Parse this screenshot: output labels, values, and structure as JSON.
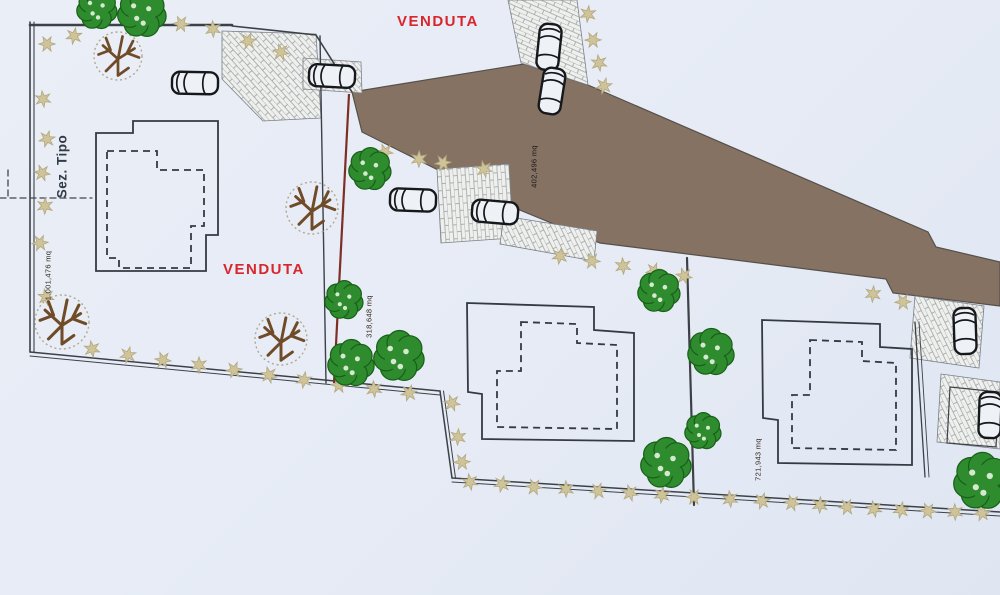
{
  "labels": {
    "venduta_top": "VENDUTA",
    "venduta_left": "VENDUTA",
    "section_label": "Sez. Tipo"
  },
  "measurements": {
    "area_left": "1.001,476 mq",
    "area_road": "402,496 mq",
    "area_middle": "318,648 mq",
    "area_right": "721,943 mq"
  },
  "colors": {
    "background": "#e8edf6",
    "road": "#867263",
    "boundary_red": "#7e2f24",
    "venduta_text": "#d8262c",
    "line_dark": "#3c4148",
    "tree_green": "#2e8b2e",
    "tree_green_dark": "#186018",
    "tree_dot_light": "#d4e9cf",
    "shrub": "#cfc39a",
    "shrub_stroke": "#b3a87d",
    "bare_branch": "#6f4b28",
    "canopy_dotted": "#b3a88c",
    "brick_fill": "#eff0eb",
    "brick_line": "#99a0aa",
    "car_fill": "#eef1f5",
    "car_stroke": "#16181b"
  },
  "symbols": {
    "green_trees": [
      {
        "x": 97,
        "y": 9,
        "r": 20
      },
      {
        "x": 142,
        "y": 13,
        "r": 24
      },
      {
        "x": 370,
        "y": 169,
        "r": 21
      },
      {
        "x": 344,
        "y": 300,
        "r": 19
      },
      {
        "x": 351,
        "y": 363,
        "r": 23
      },
      {
        "x": 399,
        "y": 356,
        "r": 25
      },
      {
        "x": 659,
        "y": 291,
        "r": 21
      },
      {
        "x": 711,
        "y": 352,
        "r": 23
      },
      {
        "x": 666,
        "y": 463,
        "r": 25
      },
      {
        "x": 703,
        "y": 431,
        "r": 18
      },
      {
        "x": 982,
        "y": 481,
        "r": 28
      }
    ],
    "bare_trees": [
      {
        "x": 118,
        "y": 56,
        "r": 24
      },
      {
        "x": 312,
        "y": 208,
        "r": 26
      },
      {
        "x": 62,
        "y": 322,
        "r": 27
      },
      {
        "x": 281,
        "y": 339,
        "r": 26
      }
    ],
    "shrub_stars": [
      [
        47,
        44
      ],
      [
        43,
        99
      ],
      [
        47,
        139
      ],
      [
        42,
        173
      ],
      [
        45,
        206
      ],
      [
        40,
        243
      ],
      [
        46,
        297
      ],
      [
        74,
        36
      ],
      [
        181,
        24
      ],
      [
        213,
        29
      ],
      [
        248,
        41
      ],
      [
        281,
        52
      ],
      [
        588,
        14
      ],
      [
        593,
        40
      ],
      [
        599,
        63
      ],
      [
        604,
        86
      ],
      [
        385,
        152
      ],
      [
        419,
        159
      ],
      [
        443,
        163
      ],
      [
        484,
        169
      ],
      [
        560,
        256
      ],
      [
        592,
        261
      ],
      [
        623,
        266
      ],
      [
        654,
        271
      ],
      [
        684,
        276
      ],
      [
        873,
        294
      ],
      [
        903,
        302
      ],
      [
        92,
        349
      ],
      [
        128,
        355
      ],
      [
        163,
        360
      ],
      [
        199,
        365
      ],
      [
        234,
        370
      ],
      [
        269,
        375
      ],
      [
        304,
        380
      ],
      [
        339,
        385
      ],
      [
        374,
        389
      ],
      [
        409,
        393
      ],
      [
        452,
        403
      ],
      [
        458,
        437
      ],
      [
        462,
        462
      ],
      [
        470,
        482
      ],
      [
        502,
        484
      ],
      [
        534,
        487
      ],
      [
        566,
        489
      ],
      [
        598,
        491
      ],
      [
        630,
        493
      ],
      [
        662,
        495
      ],
      [
        694,
        497
      ],
      [
        730,
        499
      ],
      [
        762,
        501
      ],
      [
        792,
        503
      ],
      [
        820,
        505
      ],
      [
        847,
        507
      ],
      [
        874,
        509
      ],
      [
        901,
        510
      ],
      [
        928,
        511
      ],
      [
        955,
        512
      ],
      [
        982,
        513
      ]
    ],
    "cars": [
      {
        "x": 195,
        "y": 83,
        "rot": 1
      },
      {
        "x": 332,
        "y": 76,
        "rot": 3
      },
      {
        "x": 549,
        "y": 47,
        "rot": 96
      },
      {
        "x": 552,
        "y": 91,
        "rot": 99
      },
      {
        "x": 413,
        "y": 200,
        "rot": 2
      },
      {
        "x": 495,
        "y": 212,
        "rot": 5
      },
      {
        "x": 965,
        "y": 331,
        "rot": 88
      },
      {
        "x": 990,
        "y": 415,
        "rot": 92
      }
    ]
  }
}
